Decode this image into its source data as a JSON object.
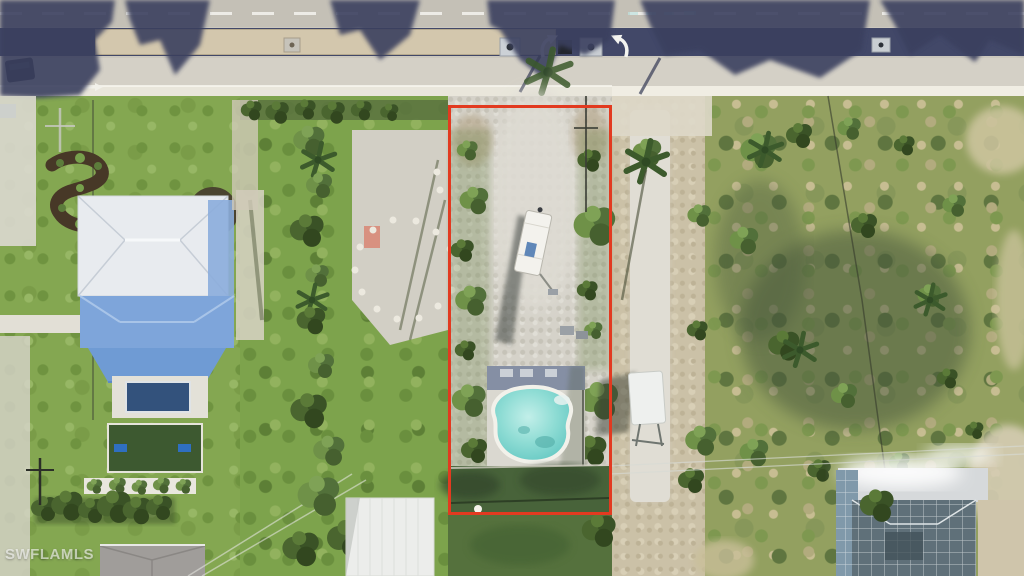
{
  "image": {
    "kind": "aerial-drone-photograph",
    "subject": "Overhead view of a vacant residential lot outlined in red, containing a gravel drive, a parked white RV trailer and a kidney-shaped in-ground pool, flanked by a blue-roofed home, green lots, a sandy drive and an overgrown parcel, with a road and painted turn arrows across the top",
    "watermark": "SWFLAMLS"
  },
  "highlight": {
    "name": "property-boundary",
    "shape": "rectangle",
    "color": "#e23a20",
    "stroke_px": 3
  },
  "road": {
    "position": "top",
    "markings": {
      "median_arrows": [
        "curved-turn-arrow",
        "u-turn-arrow"
      ],
      "lane_arrow": "right-arrow",
      "lane_divider": "dashed-white-line"
    }
  },
  "objects": [
    {
      "name": "rv-trailer",
      "color": "#f2f1ec"
    },
    {
      "name": "swimming-pool",
      "color": "#8fd8d0"
    },
    {
      "name": "pool-deck",
      "color": "#dad8d0"
    },
    {
      "name": "blue-metal-roof-house",
      "color": "#7ea5da"
    },
    {
      "name": "screened-pool-enclosure",
      "color": "#5f7079"
    },
    {
      "name": "stepping-stone-circle",
      "color": "#ece9df"
    },
    {
      "name": "garden-bed",
      "color": "#473827"
    },
    {
      "name": "parked-car",
      "color": "#22262e"
    }
  ],
  "palette": {
    "asphalt": "#cdc9bf",
    "median_navy": "#424868",
    "median_paver": "#d3c7ad",
    "building_shadow": "#3b415f",
    "grass": "#84a751",
    "scrub": "#93a060",
    "gravel": "#d5d2c9",
    "sand": "#cbc1a7",
    "sidewalk": "#ece9de",
    "pool_water": "#8fd8d0",
    "turf": "#3d5930",
    "roof_white": "#e8ebef",
    "roof_gray": "#a09d9a",
    "watermark_text": "#ffffff"
  }
}
